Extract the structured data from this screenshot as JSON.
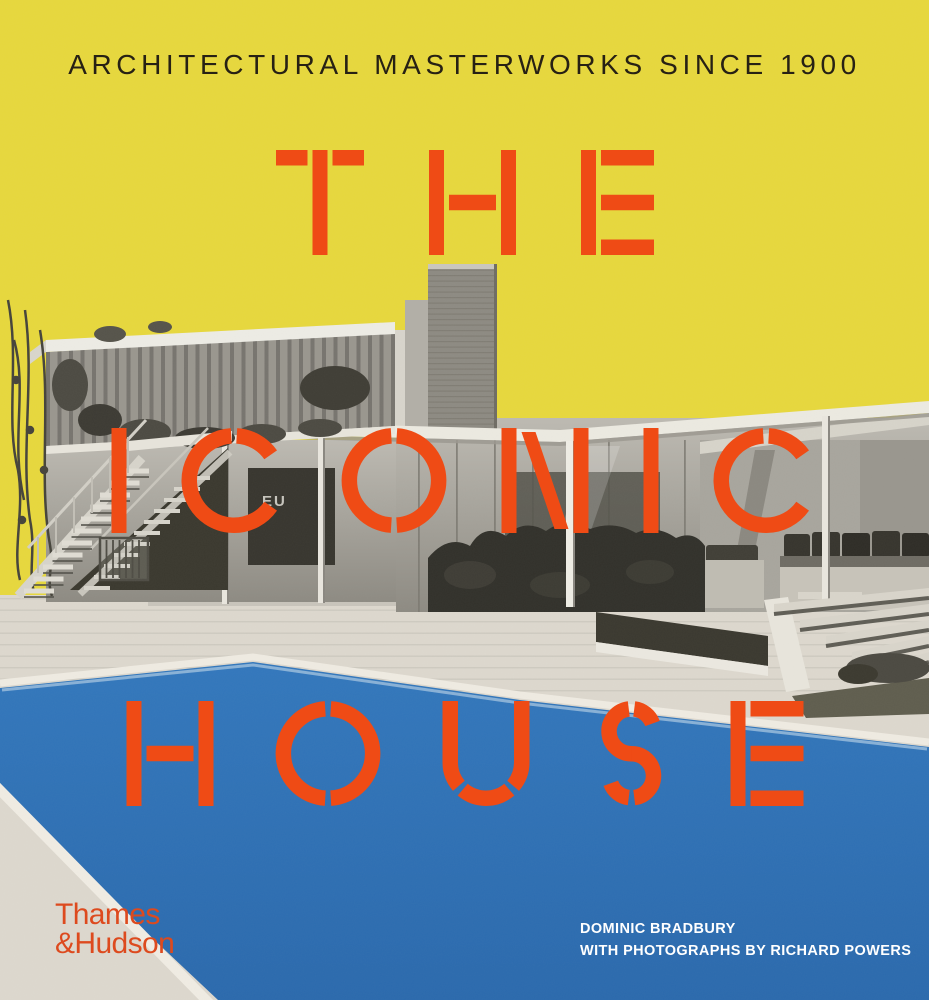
{
  "cover": {
    "tagline": "ARCHITECTURAL MASTERWORKS SINCE 1900",
    "title": {
      "line1": "THE",
      "line2": "ICONIC",
      "line3": "HOUSE"
    },
    "publisher": {
      "line1": "Thames",
      "line2": "&Hudson"
    },
    "credits": {
      "line1": "DOMINIC BRADBURY",
      "line2": "WITH PHOTOGRAPHS BY RICHARD POWERS"
    },
    "sign_text": "EU",
    "colors": {
      "yellow": "#e7d83c",
      "title_orange": "#ef4b15",
      "logo_orange": "#dd4a1e",
      "pool_blue": "#2e71b6",
      "deck_gray": "#ddd8ce",
      "fascia_white": "#eceae1",
      "hedge_dark": "#31302a",
      "tagline_ink": "#272114",
      "credit_white": "#ffffff"
    }
  }
}
